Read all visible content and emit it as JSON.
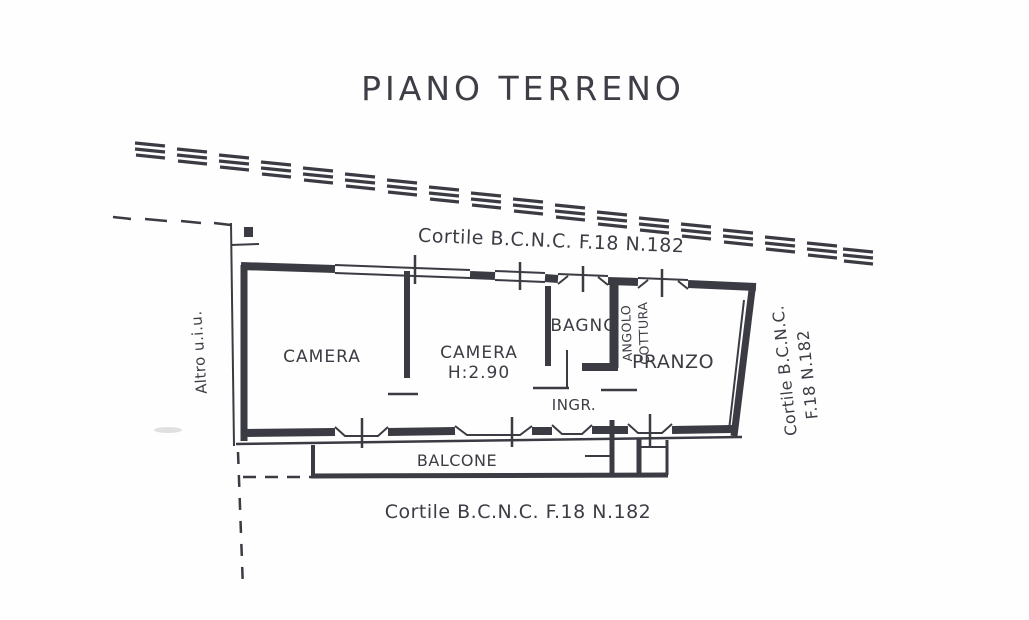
{
  "document": {
    "title": "PIANO TERRENO",
    "type_note": "scanned floor plan drawing"
  },
  "colors": {
    "ink": "#3b3b43",
    "paper": "#fefefe"
  },
  "labels": {
    "courtyard_top": "Cortile B.C.N.C. F.18 N.182",
    "courtyard_bottom": "Cortile B.C.N.C. F.18 N.182",
    "courtyard_right_line1": "Cortile B.C.N.C.",
    "courtyard_right_line2": "F.18 N.182",
    "other_unit": "Altro u.i.u."
  },
  "rooms": {
    "bedroom1": "CAMERA",
    "bedroom2": "CAMERA",
    "bedroom2_height": "H:2.90",
    "bathroom": "BAGNO",
    "kitchenette_line1": "ANGOLO",
    "kitchenette_line2": "COTTURA",
    "dining": "PRANZO",
    "entrance": "INGR.",
    "balcony": "BALCONE"
  }
}
